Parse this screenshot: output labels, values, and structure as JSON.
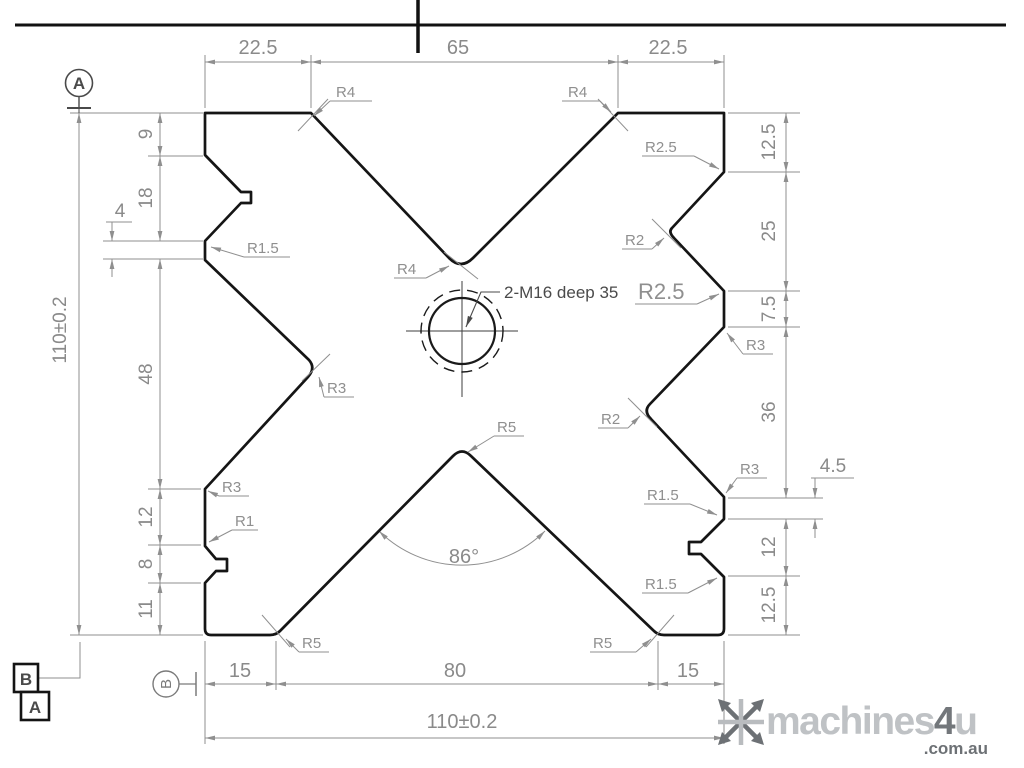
{
  "drawing": {
    "hole_note": "2-M16 deep 35",
    "angle": "86°",
    "dims": {
      "top": [
        "22.5",
        "65",
        "22.5"
      ],
      "left": [
        "9",
        "18",
        "4",
        "48",
        "12",
        "8",
        "11"
      ],
      "left_overall": "110±0.2",
      "right": [
        "12.5",
        "25",
        "7.5",
        "36",
        "4.5",
        "12",
        "12.5"
      ],
      "bottom": [
        "15",
        "80",
        "15"
      ],
      "bottom_overall": "110±0.2"
    },
    "radii": {
      "top_left_corner": "R4",
      "top_right_corner": "R4",
      "top_vee_vertex": "R4",
      "right_upper_outer": "R2.5",
      "right_upper_vertex": "R2",
      "right_upper_lower": "R2.5",
      "right_shoulder": "R3",
      "right_mid_vertex": "R2",
      "right_lower_shoulder": "R3",
      "right_tab_corner": "R1.5",
      "right_lower_corner": "R1.5",
      "left_land_corner": "R1.5",
      "left_mid_vertex": "R3",
      "left_lower_shoulder": "R3",
      "left_small_corner": "R1",
      "bottom_vee_vertex": "R5",
      "bottom_left_corner": "R5",
      "bottom_right_corner": "R5"
    },
    "datums": {
      "primary_circle": "A",
      "frame_b": "B",
      "frame_a": "A",
      "secondary_circle": "B"
    }
  },
  "watermark": {
    "word": "machines",
    "four": "4",
    "u": "u",
    "domain": ".com.au"
  },
  "colors": {
    "outline": "#151515",
    "dimension": "#8f8f8f",
    "logo_light": "#b9bcbf",
    "logo_dark": "#6d7175"
  }
}
